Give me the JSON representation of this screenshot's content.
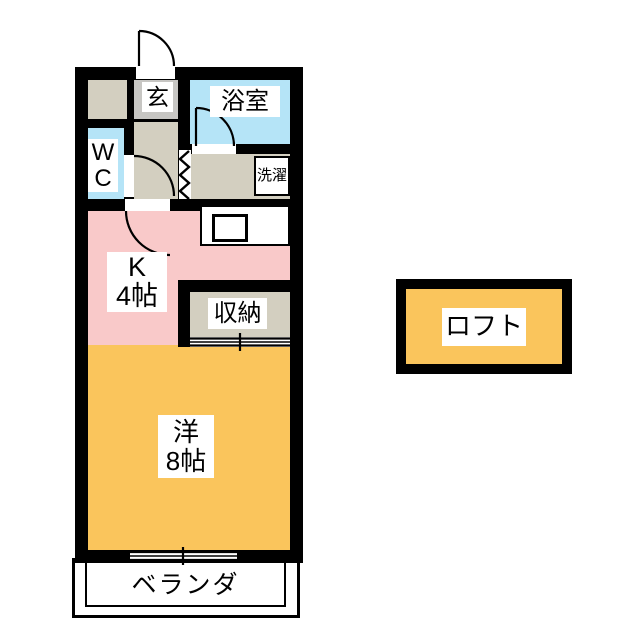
{
  "floorplan": {
    "type": "japanese-apartment-floor-plan",
    "rooms": {
      "entrance": {
        "label": "玄"
      },
      "bathroom": {
        "label": "浴室"
      },
      "toilet": {
        "label_line1": "W",
        "label_line2": "C"
      },
      "laundry": {
        "label": "洗濯"
      },
      "kitchen": {
        "label_line1": "K",
        "label_line2": "4帖"
      },
      "storage": {
        "label": "収納"
      },
      "western_room": {
        "label_line1": "洋",
        "label_line2": "8帖"
      },
      "veranda": {
        "label": "ベランダ"
      },
      "loft": {
        "label": "ロフト"
      }
    },
    "colors": {
      "wall": "#000000",
      "wet_area_blue": "#b5e4f7",
      "entrance_gray": "#c7c6c3",
      "corridor_beige": "#d3cfc0",
      "kitchen_pink": "#f9c9c9",
      "room_orange": "#fac55c",
      "background": "#ffffff"
    },
    "symbols": {
      "entrance_door": "hinged-door-arc",
      "bathroom_door": "hinged-door-arc",
      "toilet_door": "hinged-door-arc",
      "kitchen_door": "hinged-door-arc",
      "laundry_partition": "accordion-door-zigzag",
      "storage_door": "sliding-door",
      "balcony_window": "sliding-window",
      "kitchen_counter": "counter-with-sink"
    }
  }
}
